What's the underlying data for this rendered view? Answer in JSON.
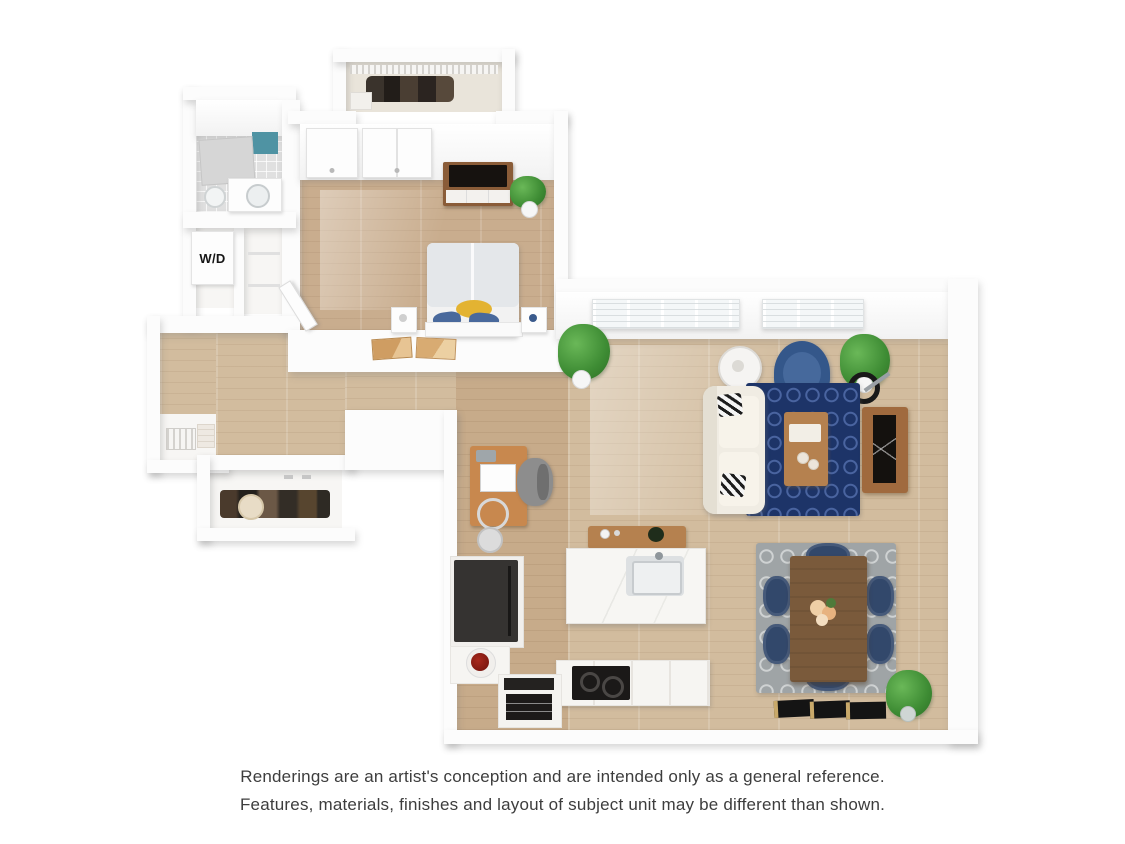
{
  "image": {
    "kind": "3d-apartment-floor-plan-rendering",
    "background": "#ffffff"
  },
  "floorplan": {
    "labels": {
      "washer_dryer": "W/D"
    },
    "rooms": [
      "bathroom",
      "laundry-closet",
      "hall-closet",
      "walk-in-closet",
      "bedroom",
      "hallway",
      "linen-closet",
      "shoe-closet",
      "office-nook",
      "kitchen",
      "living-room",
      "dining-area"
    ],
    "furniture": [
      "bathtub-shower",
      "toilet",
      "vanity-sink",
      "washer-dryer",
      "wire-shelving",
      "hanging-clothes",
      "closet-doors",
      "dresser-with-tv",
      "potted-plants",
      "bed-with-pillows",
      "nightstands",
      "wall-trays",
      "linen-basket",
      "shoe-shelf",
      "desk-with-computer",
      "office-chair",
      "kitchen-island-with-sink",
      "sideboard",
      "refrigerator",
      "fruit-bowl",
      "cooktop",
      "oven",
      "sofa",
      "accent-pillows",
      "coffee-table",
      "armchair",
      "floor-lamps",
      "media-console-with-tv",
      "navy-area-rug",
      "gray-area-rug",
      "dining-table-with-flowers",
      "dining-chairs",
      "windows",
      "leaning-mats"
    ],
    "colors": {
      "wall": "#fcfcfc",
      "wood_floor": "#d2bc9e",
      "bedroom_floor": "#c9ad8e",
      "tile_floor": "#e0e0e0",
      "shower_tile_accent": "#4f93a3",
      "rug_navy": "#1d3468",
      "rug_gray": "#9fa4a6",
      "sofa": "#f0ece3",
      "armchair_blue": "#34578a",
      "dining_chair_navy": "#32486b",
      "wood_table_dark": "#7a5a3b",
      "wood_console": "#a06a3e",
      "wood_accent": "#b5814f",
      "pillow_yellow": "#e3b332",
      "pillow_blue": "#49699c",
      "plant_green": "#3e8c34",
      "appliance_black": "#1b1918"
    }
  },
  "disclaimer": {
    "line1": "Renderings are an artist's conception and are intended only as a general reference.",
    "line2": "Features, materials, finishes and layout of subject unit may be different than shown."
  }
}
